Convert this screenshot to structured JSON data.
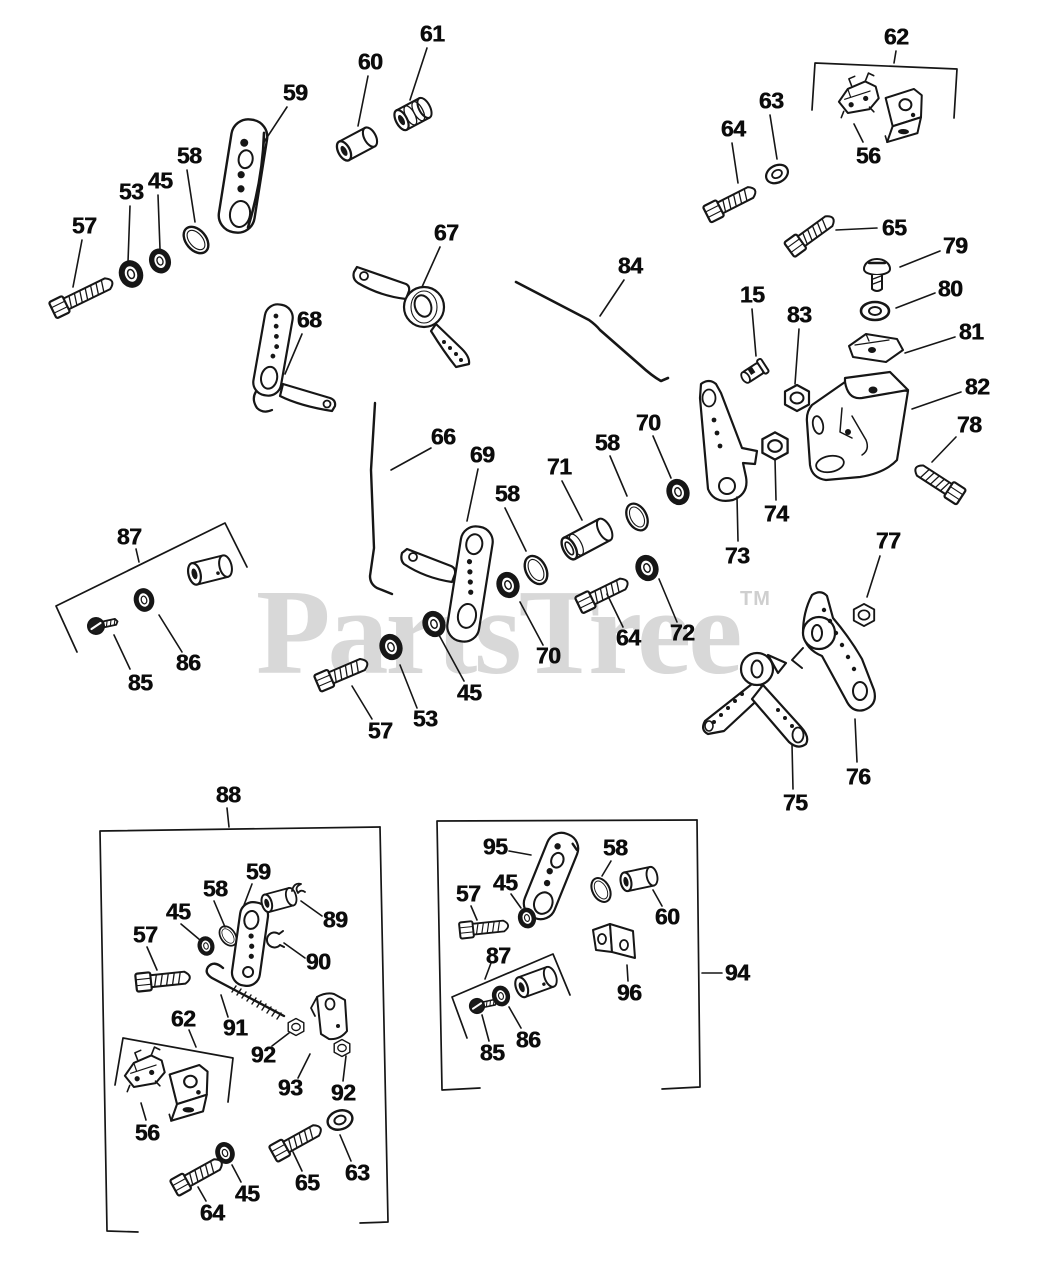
{
  "watermark": {
    "text": "PartsTree",
    "tm": "TM",
    "color": "#d8d8d8"
  },
  "colors": {
    "line": "#161616",
    "background": "#ffffff"
  },
  "callouts": [
    {
      "t": "57",
      "x": 84,
      "y": 226,
      "l": [
        82,
        240,
        73,
        287
      ]
    },
    {
      "t": "53",
      "x": 131,
      "y": 192,
      "l": [
        130,
        206,
        128,
        262
      ]
    },
    {
      "t": "45",
      "x": 160,
      "y": 181,
      "l": [
        158,
        195,
        160,
        249
      ]
    },
    {
      "t": "58",
      "x": 189,
      "y": 156,
      "l": [
        187,
        170,
        195,
        222
      ]
    },
    {
      "t": "59",
      "x": 295,
      "y": 93,
      "l": [
        287,
        107,
        264,
        142
      ]
    },
    {
      "t": "60",
      "x": 370,
      "y": 62,
      "l": [
        368,
        76,
        358,
        126
      ]
    },
    {
      "t": "61",
      "x": 432,
      "y": 34,
      "l": [
        427,
        48,
        410,
        100
      ]
    },
    {
      "t": "62",
      "x": 896,
      "y": 37,
      "l": [
        896,
        51,
        894,
        63
      ]
    },
    {
      "t": "56",
      "x": 868,
      "y": 156,
      "l": [
        863,
        142,
        854,
        124
      ]
    },
    {
      "t": "63",
      "x": 771,
      "y": 101,
      "l": [
        770,
        115,
        777,
        159
      ]
    },
    {
      "t": "64",
      "x": 733,
      "y": 129,
      "l": [
        732,
        143,
        738,
        183
      ]
    },
    {
      "t": "65",
      "x": 894,
      "y": 228,
      "l": [
        877,
        228,
        836,
        230
      ]
    },
    {
      "t": "79",
      "x": 955,
      "y": 246,
      "l": [
        940,
        251,
        900,
        267
      ]
    },
    {
      "t": "80",
      "x": 950,
      "y": 289,
      "l": [
        935,
        293,
        896,
        308
      ]
    },
    {
      "t": "81",
      "x": 971,
      "y": 332,
      "l": [
        955,
        337,
        905,
        353
      ]
    },
    {
      "t": "82",
      "x": 977,
      "y": 387,
      "l": [
        961,
        392,
        912,
        409
      ]
    },
    {
      "t": "15",
      "x": 752,
      "y": 295,
      "l": [
        752,
        309,
        756,
        356
      ]
    },
    {
      "t": "83",
      "x": 799,
      "y": 315,
      "l": [
        799,
        329,
        795,
        384
      ]
    },
    {
      "t": "78",
      "x": 969,
      "y": 425,
      "l": [
        956,
        437,
        932,
        462
      ]
    },
    {
      "t": "67",
      "x": 446,
      "y": 233,
      "l": [
        440,
        247,
        422,
        287
      ]
    },
    {
      "t": "68",
      "x": 309,
      "y": 320,
      "l": [
        302,
        334,
        285,
        374
      ]
    },
    {
      "t": "84",
      "x": 630,
      "y": 266,
      "l": [
        624,
        280,
        600,
        316
      ]
    },
    {
      "t": "66",
      "x": 443,
      "y": 437,
      "l": [
        431,
        448,
        391,
        470
      ]
    },
    {
      "t": "69",
      "x": 482,
      "y": 455,
      "l": [
        478,
        469,
        467,
        521
      ]
    },
    {
      "t": "58",
      "x": 507,
      "y": 494,
      "l": [
        505,
        508,
        526,
        551
      ]
    },
    {
      "t": "71",
      "x": 559,
      "y": 467,
      "l": [
        562,
        481,
        582,
        520
      ]
    },
    {
      "t": "58",
      "x": 607,
      "y": 443,
      "l": [
        610,
        456,
        627,
        496
      ]
    },
    {
      "t": "70",
      "x": 648,
      "y": 423,
      "l": [
        653,
        436,
        671,
        478
      ]
    },
    {
      "t": "70",
      "x": 548,
      "y": 656,
      "l": [
        543,
        645,
        520,
        602
      ]
    },
    {
      "t": "64",
      "x": 628,
      "y": 638,
      "l": [
        623,
        627,
        607,
        594
      ]
    },
    {
      "t": "72",
      "x": 682,
      "y": 633,
      "l": [
        677,
        622,
        659,
        579
      ]
    },
    {
      "t": "45",
      "x": 469,
      "y": 693,
      "l": [
        464,
        681,
        439,
        635
      ]
    },
    {
      "t": "53",
      "x": 425,
      "y": 719,
      "l": [
        417,
        708,
        400,
        665
      ]
    },
    {
      "t": "57",
      "x": 380,
      "y": 731,
      "l": [
        372,
        719,
        352,
        686
      ]
    },
    {
      "t": "73",
      "x": 737,
      "y": 556,
      "l": [
        738,
        541,
        737,
        497
      ]
    },
    {
      "t": "74",
      "x": 776,
      "y": 514,
      "l": [
        776,
        500,
        775,
        459
      ]
    },
    {
      "t": "77",
      "x": 888,
      "y": 541,
      "l": [
        880,
        556,
        867,
        597
      ]
    },
    {
      "t": "76",
      "x": 858,
      "y": 777,
      "l": [
        857,
        762,
        855,
        719
      ]
    },
    {
      "t": "75",
      "x": 795,
      "y": 803,
      "l": [
        793,
        789,
        792,
        744
      ]
    },
    {
      "t": "87",
      "x": 129,
      "y": 537,
      "l": [
        136,
        549,
        139,
        562
      ]
    },
    {
      "t": "85",
      "x": 140,
      "y": 683,
      "l": [
        130,
        669,
        114,
        635
      ]
    },
    {
      "t": "86",
      "x": 188,
      "y": 663,
      "l": [
        182,
        652,
        159,
        615
      ]
    },
    {
      "t": "88",
      "x": 228,
      "y": 795,
      "l": [
        227,
        808,
        229,
        827
      ]
    },
    {
      "t": "59",
      "x": 258,
      "y": 872,
      "l": [
        252,
        884,
        244,
        905
      ]
    },
    {
      "t": "58",
      "x": 215,
      "y": 889,
      "l": [
        214,
        901,
        225,
        927
      ]
    },
    {
      "t": "45",
      "x": 178,
      "y": 912,
      "l": [
        181,
        924,
        200,
        940
      ]
    },
    {
      "t": "57",
      "x": 145,
      "y": 935,
      "l": [
        147,
        947,
        157,
        970
      ]
    },
    {
      "t": "89",
      "x": 335,
      "y": 920,
      "l": [
        322,
        916,
        301,
        901
      ]
    },
    {
      "t": "90",
      "x": 318,
      "y": 962,
      "l": [
        305,
        958,
        284,
        943
      ]
    },
    {
      "t": "91",
      "x": 235,
      "y": 1028,
      "l": [
        228,
        1017,
        221,
        995
      ]
    },
    {
      "t": "62",
      "x": 183,
      "y": 1019,
      "l": [
        189,
        1030,
        196,
        1047
      ]
    },
    {
      "t": "56",
      "x": 147,
      "y": 1133,
      "l": [
        146,
        1120,
        141,
        1103
      ]
    },
    {
      "t": "92",
      "x": 263,
      "y": 1055,
      "l": [
        272,
        1046,
        289,
        1033
      ]
    },
    {
      "t": "93",
      "x": 290,
      "y": 1088,
      "l": [
        298,
        1078,
        310,
        1054
      ]
    },
    {
      "t": "92",
      "x": 343,
      "y": 1093,
      "l": [
        343,
        1081,
        346,
        1056
      ]
    },
    {
      "t": "63",
      "x": 357,
      "y": 1173,
      "l": [
        351,
        1161,
        340,
        1135
      ]
    },
    {
      "t": "65",
      "x": 307,
      "y": 1183,
      "l": [
        302,
        1171,
        293,
        1152
      ]
    },
    {
      "t": "45",
      "x": 247,
      "y": 1194,
      "l": [
        241,
        1182,
        232,
        1165
      ]
    },
    {
      "t": "64",
      "x": 212,
      "y": 1213,
      "l": [
        206,
        1201,
        198,
        1187
      ]
    },
    {
      "t": "94",
      "x": 737,
      "y": 973,
      "l": [
        722,
        973,
        702,
        973
      ]
    },
    {
      "t": "95",
      "x": 495,
      "y": 847,
      "l": [
        509,
        851,
        531,
        855
      ]
    },
    {
      "t": "58",
      "x": 615,
      "y": 848,
      "l": [
        611,
        861,
        602,
        876
      ]
    },
    {
      "t": "60",
      "x": 667,
      "y": 917,
      "l": [
        662,
        906,
        653,
        890
      ]
    },
    {
      "t": "45",
      "x": 505,
      "y": 883,
      "l": [
        511,
        894,
        521,
        908
      ]
    },
    {
      "t": "57",
      "x": 468,
      "y": 894,
      "l": [
        471,
        906,
        477,
        920
      ]
    },
    {
      "t": "87",
      "x": 498,
      "y": 956,
      "l": [
        491,
        963,
        485,
        979
      ]
    },
    {
      "t": "96",
      "x": 629,
      "y": 993,
      "l": [
        628,
        981,
        627,
        965
      ]
    },
    {
      "t": "85",
      "x": 492,
      "y": 1053,
      "l": [
        489,
        1041,
        482,
        1015
      ]
    },
    {
      "t": "86",
      "x": 528,
      "y": 1040,
      "l": [
        521,
        1028,
        509,
        1007
      ]
    }
  ]
}
